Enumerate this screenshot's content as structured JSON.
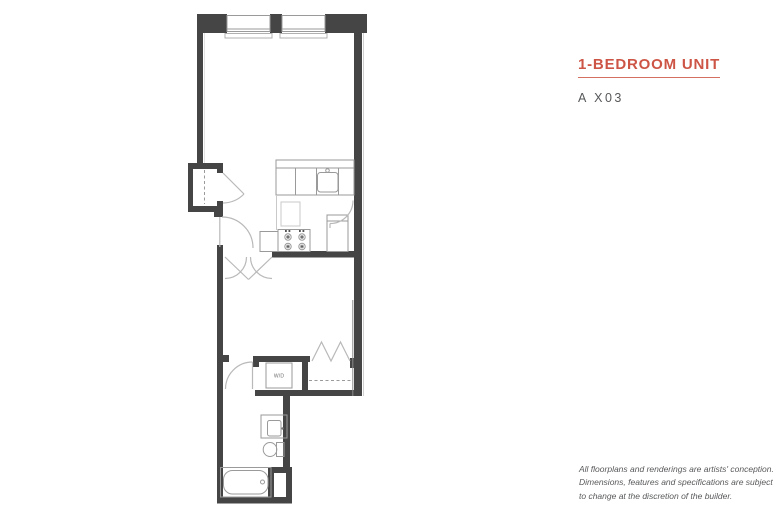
{
  "header": {
    "title": "1-BEDROOM UNIT",
    "unit_code": "A X03"
  },
  "floorplan": {
    "name": "1-bedroom unit floor plan",
    "wd_label": "W/D"
  },
  "disclaimer": {
    "line1": "All floorplans and renderings are artists' conception.",
    "line2": "Dimensions, features and specifications are subject",
    "line3": "to change at the discretion of the builder."
  },
  "colors": {
    "accent": "#cd5546",
    "wall": "#454545",
    "fixture_line": "#9a9a9a",
    "door_arc": "#b9b9b9",
    "text_gray": "#58595b"
  }
}
